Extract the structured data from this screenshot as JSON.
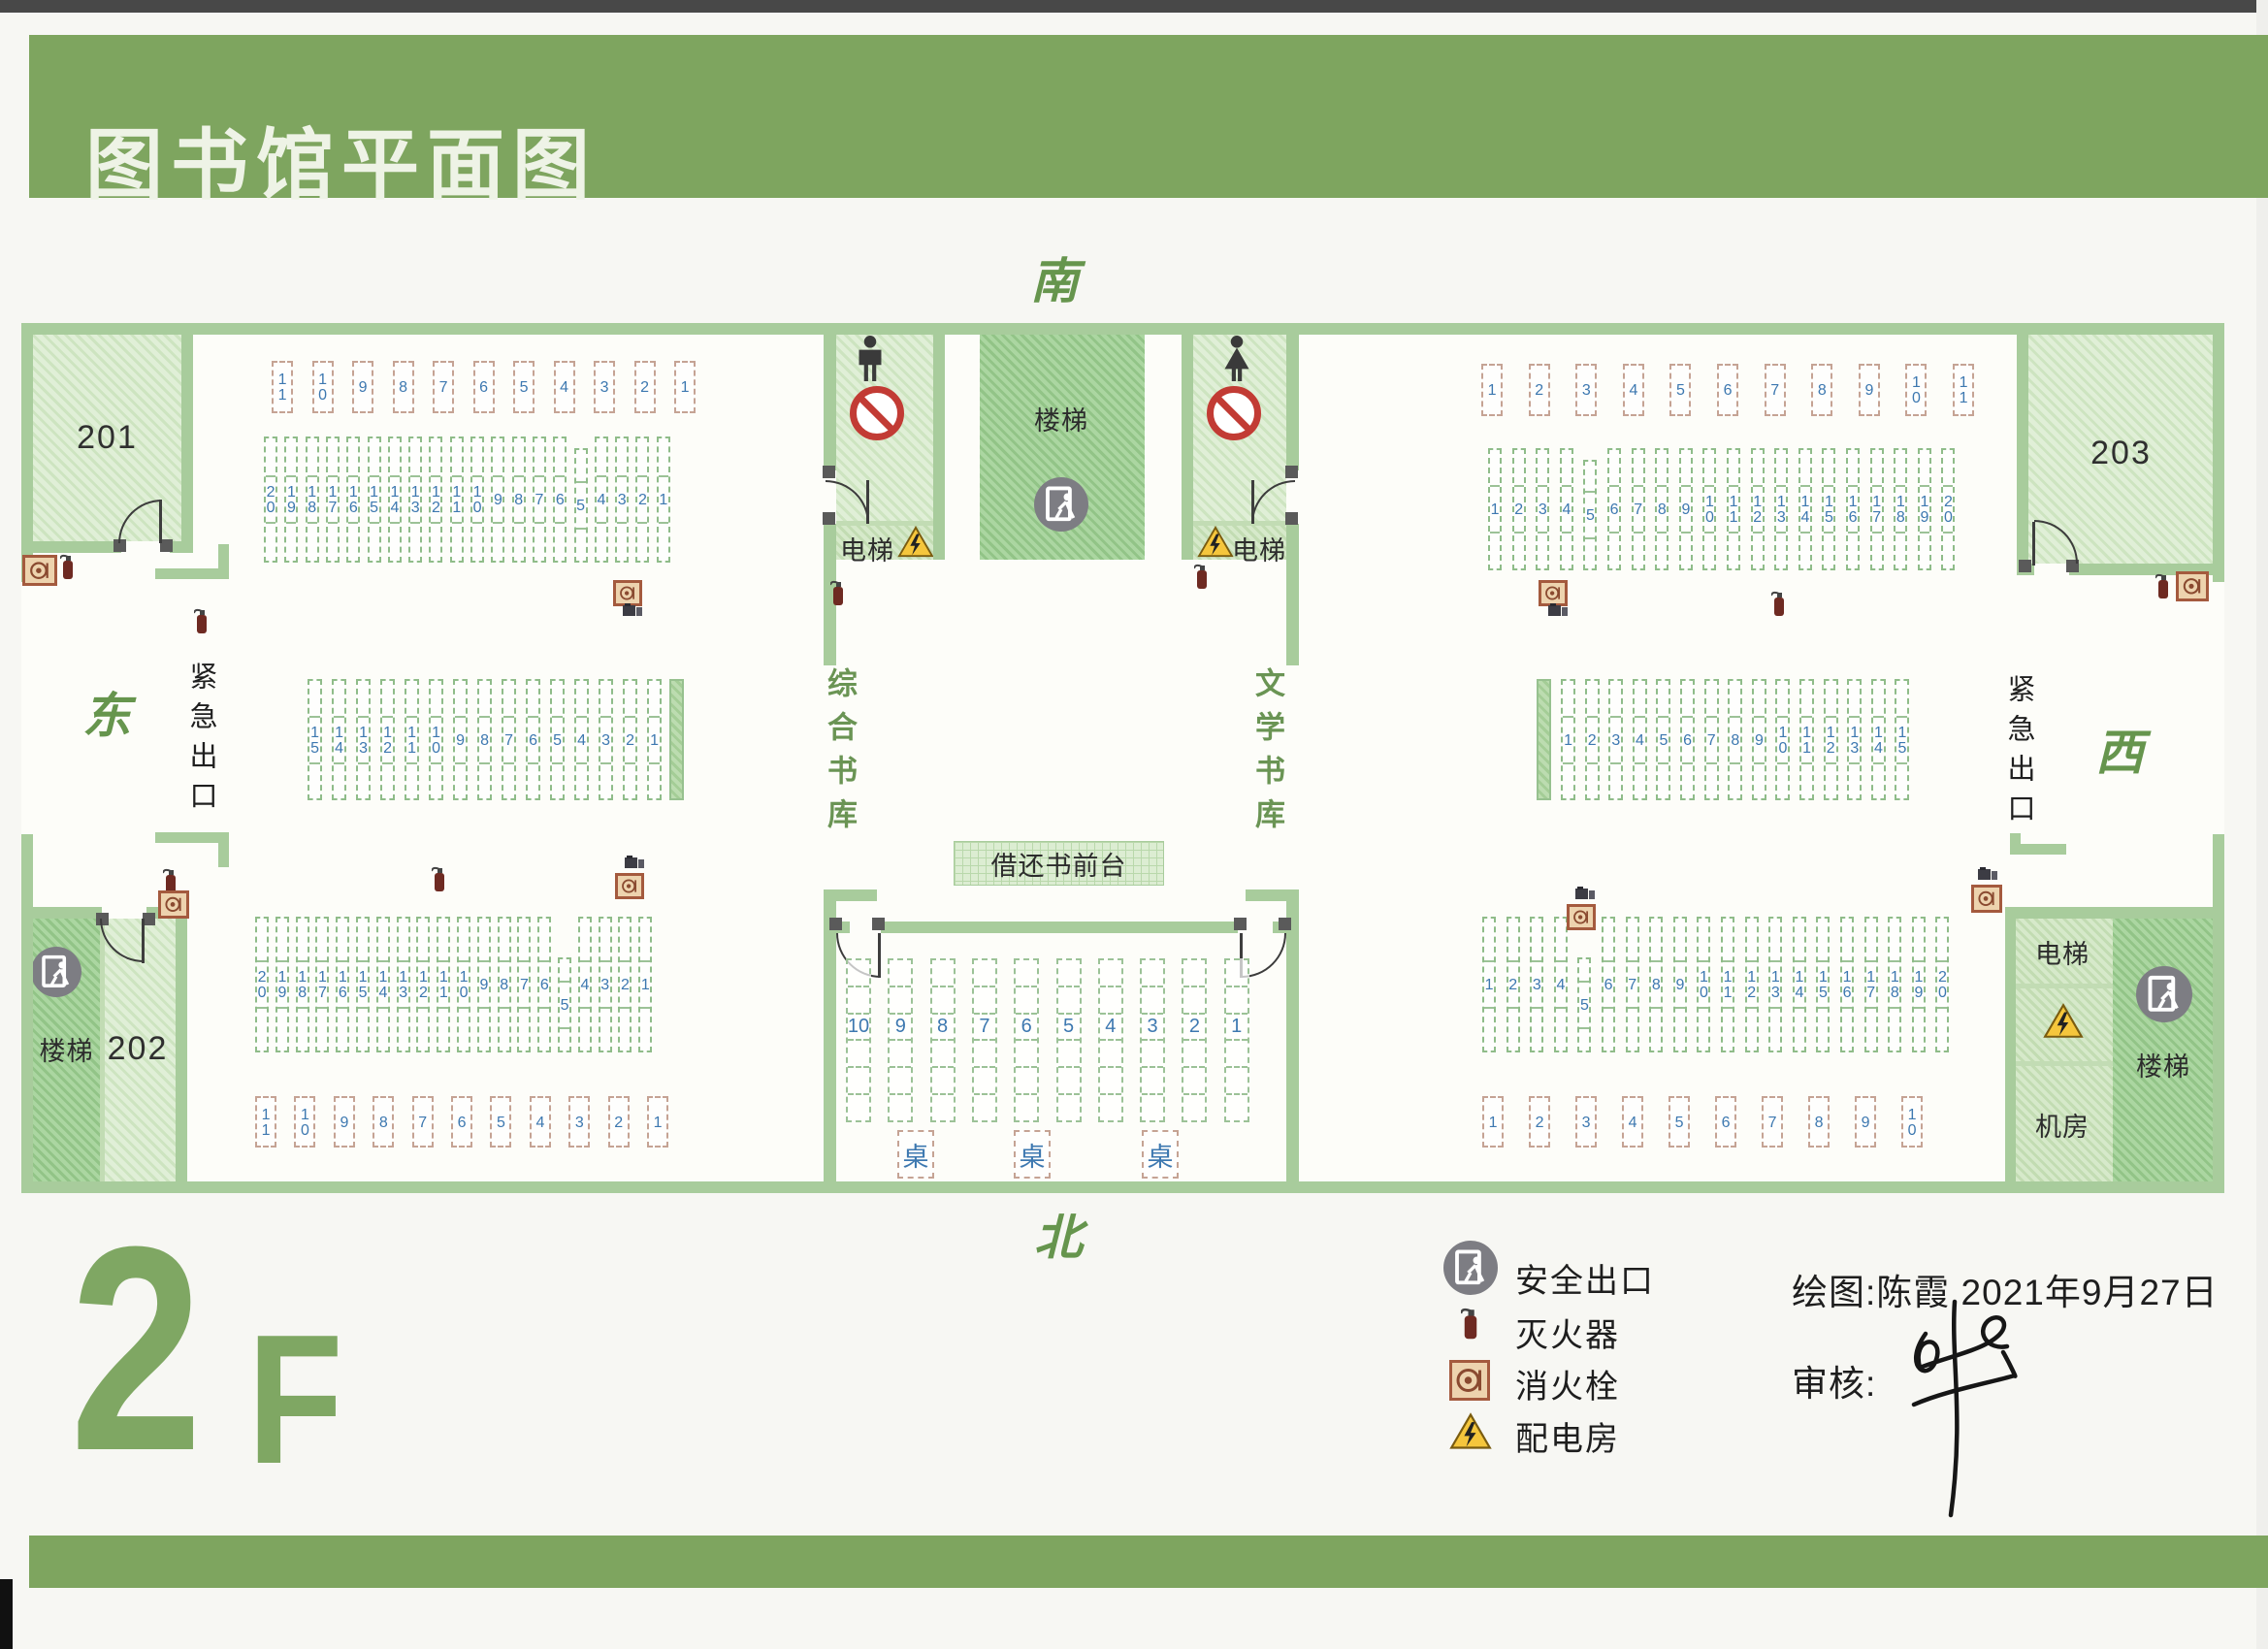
{
  "title": "图书馆平面图",
  "floor_label": {
    "number": "2",
    "suffix": "F"
  },
  "compass": {
    "south": "南",
    "north": "北",
    "east": "东",
    "west": "西"
  },
  "rooms": {
    "room_201": "201",
    "room_202": "202",
    "room_203": "203",
    "stairs": "楼梯",
    "elevator": "电梯",
    "machine_room": "机房",
    "emergency_exit": "紧急出口",
    "general_stacks": "综合书库",
    "literature_stacks": "文学书库",
    "circulation_desk": "借还书前台",
    "desk_label": "桌"
  },
  "legend": {
    "items": [
      {
        "icon": "safety-exit-icon",
        "label": "安全出口"
      },
      {
        "icon": "fire-extinguisher-icon",
        "label": "灭火器"
      },
      {
        "icon": "fire-hydrant-icon",
        "label": "消火栓"
      },
      {
        "icon": "power-room-icon",
        "label": "配电房"
      }
    ]
  },
  "credits": {
    "drawn_by": "绘图:陈霞  2021年9月27日",
    "reviewer": "审核:"
  },
  "shelves": {
    "left_top_row": [
      "11",
      "10",
      "9",
      "8",
      "7",
      "6",
      "5",
      "4",
      "3",
      "2",
      "1"
    ],
    "left_upper": [
      "20",
      "19",
      "18",
      "17",
      "16",
      "15",
      "14",
      "13",
      "12",
      "11",
      "10",
      "9",
      "8",
      "7",
      "6",
      "5",
      "4",
      "3",
      "2",
      "1"
    ],
    "left_middle": [
      "15",
      "14",
      "13",
      "12",
      "11",
      "10",
      "9",
      "8",
      "7",
      "6",
      "5",
      "4",
      "3",
      "2",
      "1"
    ],
    "left_lower": [
      "20",
      "19",
      "18",
      "17",
      "16",
      "15",
      "14",
      "13",
      "12",
      "11",
      "10",
      "9",
      "8",
      "7",
      "6",
      "5",
      "4",
      "3",
      "2",
      "1"
    ],
    "left_bottom_row": [
      "11",
      "10",
      "9",
      "8",
      "7",
      "6",
      "5",
      "4",
      "3",
      "2",
      "1"
    ],
    "right_top_row": [
      "1",
      "2",
      "3",
      "4",
      "5",
      "6",
      "7",
      "8",
      "9",
      "10",
      "11"
    ],
    "right_upper": [
      "1",
      "2",
      "3",
      "4",
      "5",
      "6",
      "7",
      "8",
      "9",
      "10",
      "11",
      "12",
      "13",
      "14",
      "15",
      "16",
      "17",
      "18",
      "19",
      "20"
    ],
    "right_middle": [
      "1",
      "2",
      "3",
      "4",
      "5",
      "6",
      "7",
      "8",
      "9",
      "10",
      "11",
      "12",
      "13",
      "14",
      "15"
    ],
    "right_lower": [
      "1",
      "2",
      "3",
      "4",
      "5",
      "6",
      "7",
      "8",
      "9",
      "10",
      "11",
      "12",
      "13",
      "14",
      "15",
      "16",
      "17",
      "18",
      "19",
      "20"
    ],
    "right_bottom_row": [
      "1",
      "2",
      "3",
      "4",
      "5",
      "6",
      "7",
      "8",
      "9",
      "10"
    ],
    "center_tables": [
      "10",
      "9",
      "8",
      "7",
      "6",
      "5",
      "4",
      "3",
      "2",
      "1"
    ]
  },
  "colors": {
    "band_green": "#7ea55f",
    "wall_green": "#a8cc9c",
    "number_blue": "#3d78b0",
    "direction_green": "#66954d",
    "warning_yellow": "#f5c63c",
    "no_entry_red": "#c23b34"
  }
}
